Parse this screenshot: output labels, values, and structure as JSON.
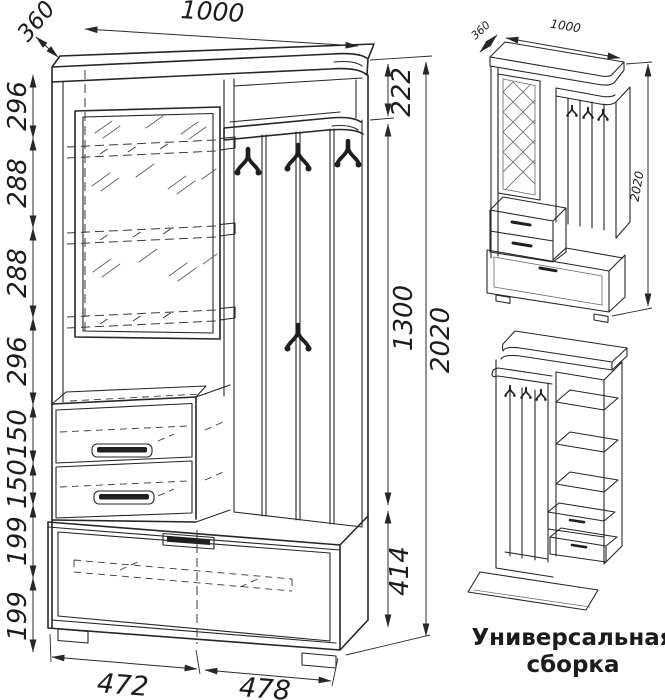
{
  "front_view": {
    "dim_width_top": "1000",
    "dim_depth_top": "360",
    "dims_left": [
      "296",
      "288",
      "288",
      "296",
      "150",
      "150",
      "199",
      "199"
    ],
    "dims_right": [
      "222",
      "1300",
      "414"
    ],
    "dim_height_total": "2020",
    "dims_bottom": [
      "472",
      "478"
    ]
  },
  "assembly_views": {
    "dim_depth": "360",
    "dim_width": "1000",
    "dim_height": "2020",
    "caption": {
      "line1": "Универсальная",
      "line2": "сборка"
    }
  },
  "style": {
    "line_color": "#262626",
    "background": "#ffffff"
  }
}
